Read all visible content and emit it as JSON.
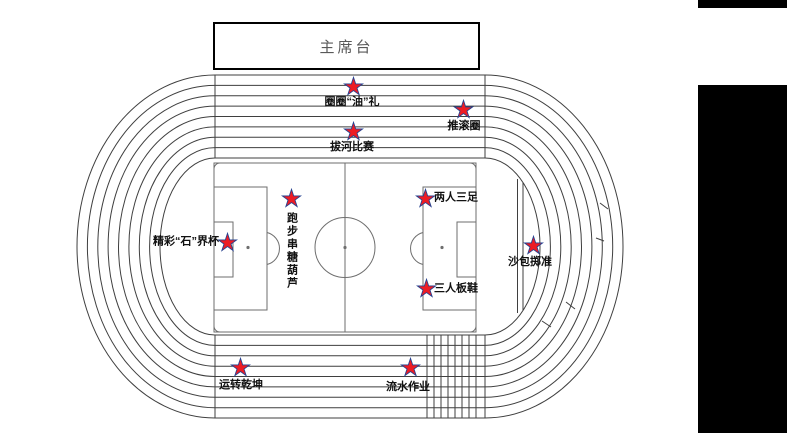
{
  "rostrum": {
    "label": "主席台"
  },
  "colors": {
    "star_fill": "#ed1c24",
    "star_stroke": "#26418f",
    "track_line": "#3f3f3f",
    "field_line": "#6e6e6e",
    "label_text": "#111111",
    "rostrum_text": "#595959",
    "panel": "#000000"
  },
  "stations": [
    {
      "id": "quanquan-youli",
      "label": "圈圈“油”礼",
      "placement": "below",
      "star": {
        "x": 353,
        "y": 86
      },
      "label_pos": {
        "x": 352,
        "y": 96
      }
    },
    {
      "id": "tui-gun-quan",
      "label": "推滚圈",
      "placement": "below",
      "star": {
        "x": 463,
        "y": 109
      },
      "label_pos": {
        "x": 464,
        "y": 120
      }
    },
    {
      "id": "bahe-bisai",
      "label": "拔河比赛",
      "placement": "below",
      "star": {
        "x": 353,
        "y": 131
      },
      "label_pos": {
        "x": 352,
        "y": 141
      }
    },
    {
      "id": "paobu-chuan-tanghulu",
      "label": "跑步串糖葫芦",
      "placement": "below-vertical",
      "star": {
        "x": 291,
        "y": 198
      },
      "label_pos": {
        "x": 291,
        "y": 212
      }
    },
    {
      "id": "jingcai-shi-jie-bei",
      "label": "精彩“石”界杯",
      "placement": "left",
      "star": {
        "x": 227,
        "y": 242
      },
      "label_pos": {
        "x": 219,
        "y": 242
      }
    },
    {
      "id": "liangren-sanzu",
      "label": "两人三足",
      "placement": "right",
      "star": {
        "x": 425,
        "y": 198
      },
      "label_pos": {
        "x": 434,
        "y": 198
      }
    },
    {
      "id": "sanren-banxie",
      "label": "三人板鞋",
      "placement": "right",
      "star": {
        "x": 426,
        "y": 288
      },
      "label_pos": {
        "x": 434,
        "y": 289
      }
    },
    {
      "id": "shabao-zhizhun",
      "label": "沙包掷准",
      "placement": "below",
      "star": {
        "x": 533,
        "y": 245
      },
      "label_pos": {
        "x": 530,
        "y": 256
      }
    },
    {
      "id": "yunzhuan-qiankun",
      "label": "运转乾坤",
      "placement": "below",
      "star": {
        "x": 240,
        "y": 367
      },
      "label_pos": {
        "x": 241,
        "y": 379
      }
    },
    {
      "id": "liushui-zuoye",
      "label": "流水作业",
      "placement": "below",
      "star": {
        "x": 410,
        "y": 367
      },
      "label_pos": {
        "x": 408,
        "y": 381
      }
    }
  ],
  "star_icon": {
    "points": "12,1 14.47,8.6 22.46,8.6 16,13.3 18.47,20.9 12,16.2 5.53,20.9 8,13.3 1.54,8.6 9.53,8.6"
  }
}
